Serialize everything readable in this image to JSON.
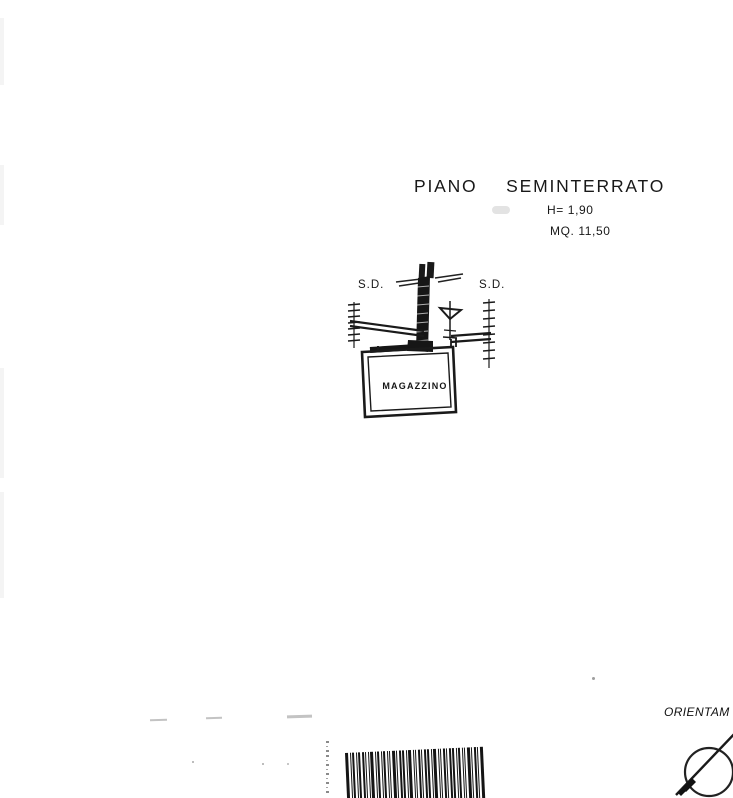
{
  "page": {
    "background": "#ffffff",
    "ink": "#1c1c1c"
  },
  "title": {
    "floor_label": "PIANO SEMINTERRATO",
    "height_label": "H= 1,90",
    "area_label": "MQ. 11,50"
  },
  "plan": {
    "left_door_label": "S.D.",
    "right_door_label": "S.D.",
    "room_label": "MAGAZZINO"
  },
  "compass": {
    "orientation_label": "ORIENTAM"
  },
  "barcode": {
    "pattern": "31212211312121131221311212213112122121131213"
  }
}
